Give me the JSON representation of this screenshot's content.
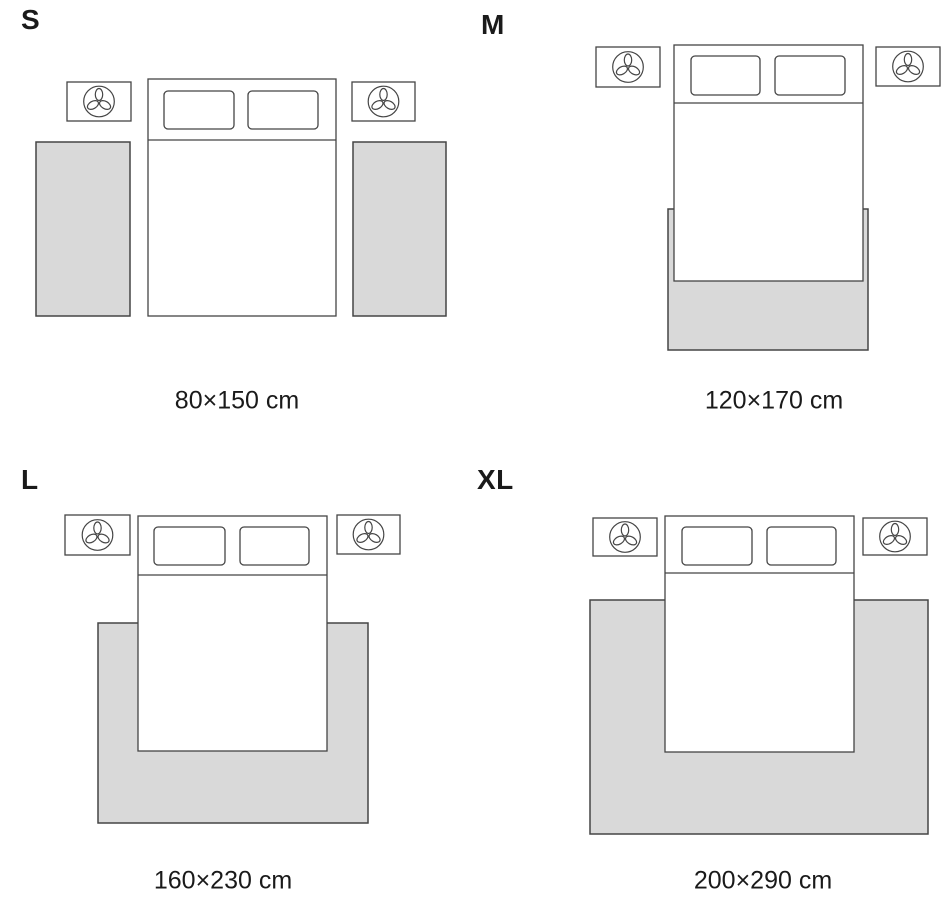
{
  "page": {
    "background": "#ffffff",
    "description": "Rug size guide showing rug placement around a double bed for four sizes"
  },
  "colors": {
    "rug_fill": "#d9d9d9",
    "outline": "#454545",
    "text_color": "#1a1a1a"
  },
  "icons": {
    "nightstand_decor": "plant-icon"
  },
  "panels": [
    {
      "id": "S",
      "label": "S",
      "dimension": "80×150 cm",
      "rug_layout": "two-bedside-runners"
    },
    {
      "id": "M",
      "label": "M",
      "dimension": "120×170 cm",
      "rug_layout": "under-foot-of-bed"
    },
    {
      "id": "L",
      "label": "L",
      "dimension": "160×230 cm",
      "rug_layout": "under-lower-two-thirds"
    },
    {
      "id": "XL",
      "label": "XL",
      "dimension": "200×290 cm",
      "rug_layout": "full-width-under-bed"
    }
  ]
}
